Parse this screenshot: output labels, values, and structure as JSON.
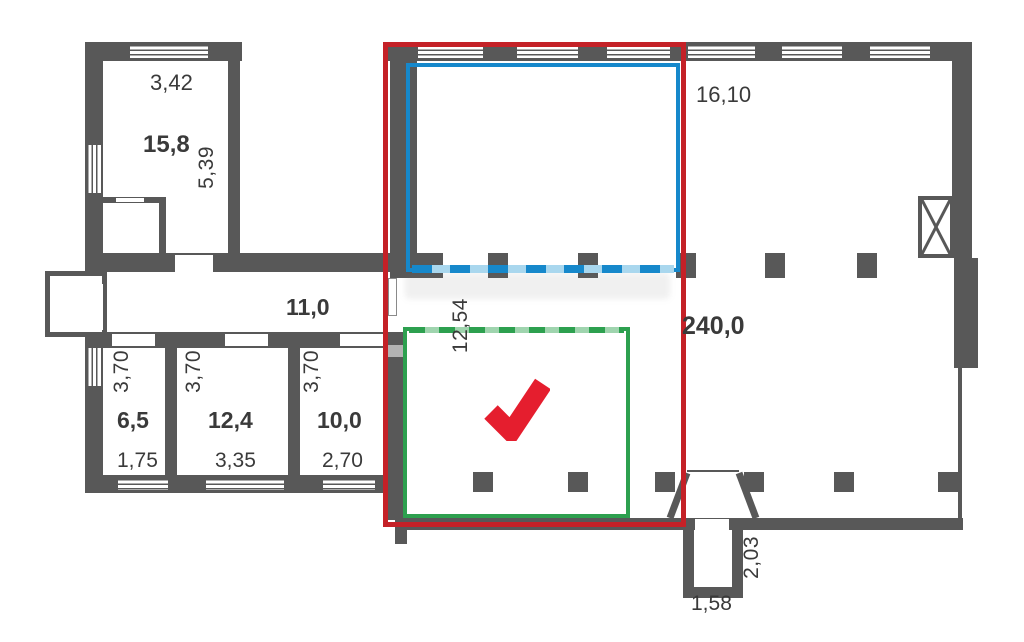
{
  "title": "Floor plan with highlighted areas",
  "colors": {
    "wall": "#585858",
    "selection_red": "#c42127",
    "selection_blue": "#1688cb",
    "selection_green": "#2da04f",
    "checkmark_red": "#e51e2e",
    "label_text": "#3a3a3a"
  },
  "icons": {
    "checkmark": "check-icon",
    "shaft": "crossed-box-icon"
  },
  "labels": {
    "room_top_left": {
      "width": "3,42",
      "area": "15,8",
      "depth": "5,39"
    },
    "corridor": {
      "area": "11,0"
    },
    "hall": {
      "top_width": "16,10",
      "area": "240,0",
      "inner_width": "12,54"
    },
    "room_small": {
      "depth": "3,70",
      "area": "6,5",
      "width": "1,75"
    },
    "room_middle": {
      "depth": "3,70",
      "area": "12,4",
      "width": "3,35"
    },
    "room_right": {
      "depth": "3,70",
      "area": "10,0",
      "width": "2,70"
    },
    "vestibule": {
      "depth": "2,03",
      "width": "1,58"
    }
  }
}
